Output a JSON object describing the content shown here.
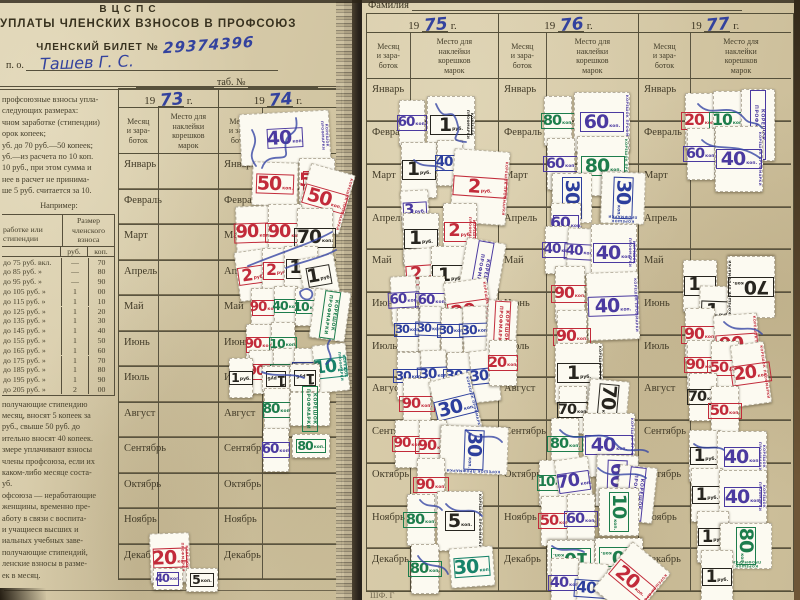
{
  "left_page": {
    "org": "ВЦСПС",
    "title": "УПЛАТЫ ЧЛЕНСКИХ ВЗНОСОВ В ПРОФСОЮЗ",
    "billet_label": "ЧЛЕНСКИЙ БИЛЕТ №",
    "billet_number": "29374396",
    "po_label": "п.  о.",
    "name_hand": "Ташев  Г.  С.",
    "tab_label": "таб.  №",
    "years": [
      "73",
      "74"
    ],
    "intro_lines": [
      "профсоюзные взносы упла-",
      "следующих размерах:",
      "чном заработке (стипендии)",
      "орок копеек;",
      "уб. до 70 руб.—50 копеек;",
      "уб.—из расчета по 10 коп.",
      "10 руб., при этом сумма и",
      "нее в расчет не принима-",
      "ше 5 руб. считается за 10."
    ],
    "example_label": "Например:",
    "rate_table": {
      "col1": "работке или\nстипендии",
      "col2": "Размер\nчленского\nвзноса",
      "rub": "руб.",
      "kop": "коп.",
      "rows": [
        [
          "до  75 руб. вкл.",
          "—",
          "70"
        ],
        [
          "до  85 руб.  »",
          "—",
          "80"
        ],
        [
          "до  95 руб.  »",
          "—",
          "90"
        ],
        [
          "до 105 руб.  »",
          "1",
          "00"
        ],
        [
          "до 115 руб.  »",
          "1",
          "10"
        ],
        [
          "до 125 руб.  »",
          "1",
          "20"
        ],
        [
          "до 135 руб.  »",
          "1",
          "30"
        ],
        [
          "до 145 руб.  »",
          "1",
          "40"
        ],
        [
          "до 155 руб.  »",
          "1",
          "50"
        ],
        [
          "до 165 руб.  »",
          "1",
          "60"
        ],
        [
          "до 175 руб.  »",
          "1",
          "70"
        ],
        [
          "до 185 руб.  »",
          "1",
          "80"
        ],
        [
          "до 195 руб.  »",
          "1",
          "90"
        ],
        [
          "до 205 руб.  »",
          "2",
          "00"
        ]
      ]
    },
    "bottom_lines": [
      "получающие  стипендию",
      "месяц, вносят 5 копеек за",
      "руб.,  свыше  50  руб.  до",
      "ительно вносят 40 копеек.",
      "змере уплачивают взносы",
      "члены профсоюза, если их",
      "каком-либо месяце соста-",
      "уб.",
      "офсоюза — неработающие",
      "женщины,  временно  пре-",
      "аботу в связи с воспита-",
      "и  учащиеся  высших  и",
      "иальных  учебных  заве-",
      "получающие   стипендий,",
      "ленские взносы в разме-",
      "ек в месяц."
    ]
  },
  "right_page": {
    "family_label": "Фамилия",
    "years": [
      "75",
      "76",
      "77"
    ],
    "footer": "ШФ. Г"
  },
  "table": {
    "year_prefix": "19",
    "year_suffix": "г.",
    "month_col": "Месяц\nи зара-\nботок",
    "place_col": "Место для\nнаклейки\nкорешков\nмарок",
    "months": [
      "Январь",
      "Февраль",
      "Март",
      "Апрель",
      "Май",
      "Июнь",
      "Июль",
      "Август",
      "Сентябрь",
      "Октябрь",
      "Ноябрь",
      "Декабрь"
    ]
  },
  "stamps": {
    "side_label": "КОРЕШОК ПРОФМАРКИ",
    "unit_kop": "коп.",
    "unit_rub": "руб.",
    "colors": {
      "red": "#c22b3a",
      "pur": "#4b3aa0",
      "grn": "#1d7d4c",
      "blu": "#2d3f9d",
      "blk": "#27251f",
      "tea": "#17836a"
    },
    "items": [
      [
        240,
        112,
        90,
        52,
        -3,
        "pur",
        "40",
        "k",
        "sv"
      ],
      [
        252,
        162,
        46,
        44,
        2,
        "red",
        "50",
        "k",
        ""
      ],
      [
        299,
        158,
        36,
        46,
        0,
        "red",
        "50",
        "k",
        ""
      ],
      [
        302,
        168,
        46,
        62,
        16,
        "red",
        "50",
        "k",
        "sv"
      ],
      [
        236,
        206,
        34,
        54,
        -2,
        "red",
        "90",
        "k",
        "v"
      ],
      [
        268,
        204,
        34,
        58,
        0,
        "red",
        "90",
        "k",
        "v"
      ],
      [
        297,
        208,
        36,
        60,
        0,
        "blk",
        "70",
        "k",
        "v"
      ],
      [
        237,
        250,
        32,
        50,
        -8,
        "red",
        "2",
        "r",
        "v"
      ],
      [
        262,
        248,
        30,
        46,
        0,
        "red",
        "2",
        "r",
        "v"
      ],
      [
        284,
        246,
        34,
        46,
        0,
        "blk",
        "1",
        "r",
        "v"
      ],
      [
        301,
        256,
        36,
        40,
        -10,
        "blk",
        "1",
        "r",
        "v"
      ],
      [
        251,
        288,
        26,
        40,
        0,
        "red",
        "90",
        "k",
        "v"
      ],
      [
        274,
        286,
        24,
        40,
        0,
        "grn",
        "40",
        "k",
        "v"
      ],
      [
        295,
        288,
        24,
        38,
        0,
        "grn",
        "10",
        "k",
        "v"
      ],
      [
        312,
        290,
        36,
        50,
        8,
        "grn",
        "",
        "k",
        "sb"
      ],
      [
        246,
        324,
        26,
        42,
        0,
        "red",
        "90",
        "k",
        "v"
      ],
      [
        271,
        322,
        24,
        44,
        0,
        "grn",
        "10",
        "k",
        "v"
      ],
      [
        249,
        350,
        26,
        44,
        0,
        "red",
        "90",
        "k",
        "v"
      ],
      [
        273,
        348,
        24,
        46,
        0,
        "grn",
        "40",
        "k",
        "v"
      ],
      [
        294,
        348,
        22,
        42,
        0,
        "blu",
        "10",
        "k",
        "v"
      ],
      [
        314,
        344,
        34,
        48,
        -6,
        "tea",
        "10",
        "k",
        "sv"
      ],
      [
        229,
        358,
        24,
        40,
        0,
        "blk",
        "1",
        "r",
        "v"
      ],
      [
        262,
        366,
        28,
        26,
        180,
        "blk",
        "1",
        "r",
        ""
      ],
      [
        290,
        364,
        30,
        28,
        180,
        "blk",
        "1",
        "r",
        ""
      ],
      [
        264,
        388,
        26,
        44,
        0,
        "grn",
        "80",
        "k",
        "v"
      ],
      [
        290,
        392,
        40,
        34,
        0,
        "grn",
        "",
        "k",
        "sb"
      ],
      [
        263,
        428,
        26,
        44,
        0,
        "pur",
        "60",
        "k",
        "v"
      ],
      [
        292,
        434,
        38,
        24,
        0,
        "grn",
        "80",
        "k",
        ""
      ],
      [
        150,
        533,
        40,
        50,
        -2,
        "red",
        "20",
        "k",
        "sv"
      ],
      [
        153,
        568,
        30,
        22,
        0,
        "pur",
        "40",
        "k",
        ""
      ],
      [
        186,
        568,
        32,
        24,
        0,
        "blk",
        "5",
        "k",
        ""
      ],
      [
        399,
        100,
        26,
        46,
        0,
        "pur",
        "60",
        "k",
        "v"
      ],
      [
        427,
        96,
        48,
        58,
        0,
        "blk",
        "1",
        "r",
        "sv"
      ],
      [
        401,
        142,
        36,
        56,
        0,
        "blk",
        "1",
        "r",
        "v"
      ],
      [
        437,
        140,
        26,
        46,
        0,
        "blu",
        "40",
        "k",
        "v"
      ],
      [
        452,
        150,
        56,
        74,
        4,
        "red",
        "2",
        "r",
        "sv"
      ],
      [
        401,
        190,
        28,
        40,
        -3,
        "pur",
        "3",
        "r",
        "v"
      ],
      [
        403,
        213,
        36,
        52,
        0,
        "blk",
        "1",
        "r",
        "v"
      ],
      [
        443,
        203,
        34,
        58,
        0,
        "red",
        "2",
        "r",
        "sv"
      ],
      [
        405,
        248,
        34,
        54,
        -4,
        "red",
        "2",
        "r",
        "v"
      ],
      [
        431,
        246,
        38,
        58,
        0,
        "blk",
        "1",
        "r",
        "v"
      ],
      [
        461,
        240,
        40,
        68,
        10,
        "pur",
        "",
        "k",
        "sb"
      ],
      [
        391,
        276,
        26,
        48,
        -3,
        "pur",
        "60",
        "k",
        "v"
      ],
      [
        419,
        276,
        26,
        50,
        0,
        "pur",
        "60",
        "k",
        "v"
      ],
      [
        447,
        280,
        44,
        62,
        -8,
        "red",
        "20",
        "k",
        "sv"
      ],
      [
        397,
        308,
        22,
        44,
        0,
        "blu",
        "30",
        "k",
        "v"
      ],
      [
        419,
        306,
        22,
        46,
        2,
        "blu",
        "30",
        "k",
        "v"
      ],
      [
        441,
        308,
        22,
        46,
        0,
        "blu",
        "30",
        "k",
        "v"
      ],
      [
        463,
        306,
        24,
        48,
        -2,
        "blu",
        "30",
        "k",
        "v"
      ],
      [
        487,
        300,
        30,
        52,
        3,
        "red",
        "",
        "k",
        "sb"
      ],
      [
        397,
        352,
        24,
        48,
        0,
        "blu",
        "30",
        "k",
        "v"
      ],
      [
        421,
        350,
        26,
        50,
        -2,
        "blu",
        "30",
        "k",
        "v"
      ],
      [
        447,
        352,
        26,
        50,
        0,
        "blu",
        "30",
        "k",
        "v"
      ],
      [
        471,
        350,
        28,
        52,
        -6,
        "blu",
        "30",
        "k",
        "v"
      ],
      [
        489,
        340,
        28,
        46,
        0,
        "red",
        "20",
        "k",
        "v"
      ],
      [
        403,
        378,
        28,
        52,
        0,
        "red",
        "90",
        "k",
        "v"
      ],
      [
        435,
        376,
        42,
        62,
        -14,
        "blu",
        "30",
        "k",
        "sv"
      ],
      [
        395,
        420,
        26,
        48,
        0,
        "red",
        "90",
        "k",
        "v"
      ],
      [
        419,
        420,
        28,
        52,
        0,
        "red",
        "90",
        "k",
        "v"
      ],
      [
        450,
        416,
        48,
        68,
        92,
        "blu",
        "30",
        "k",
        "s"
      ],
      [
        417,
        458,
        28,
        54,
        0,
        "red",
        "90",
        "k",
        "v"
      ],
      [
        407,
        494,
        28,
        52,
        0,
        "grn",
        "80",
        "k",
        "v"
      ],
      [
        437,
        491,
        46,
        60,
        0,
        "blk",
        "5",
        "k",
        "s"
      ],
      [
        411,
        544,
        28,
        50,
        0,
        "grn",
        "80",
        "k",
        "v"
      ],
      [
        450,
        547,
        44,
        40,
        -4,
        "tea",
        "30",
        "k",
        ""
      ],
      [
        544,
        96,
        28,
        50,
        0,
        "grn",
        "80",
        "k",
        "v"
      ],
      [
        574,
        92,
        56,
        60,
        0,
        "pur",
        "60",
        "k",
        "sv"
      ],
      [
        547,
        138,
        28,
        52,
        0,
        "pur",
        "60",
        "k",
        "v"
      ],
      [
        577,
        136,
        52,
        60,
        0,
        "grn",
        "80",
        "k",
        "sv"
      ],
      [
        547,
        178,
        50,
        40,
        90,
        "blu",
        "30",
        "k",
        ""
      ],
      [
        597,
        176,
        52,
        44,
        92,
        "blu",
        "30",
        "k",
        "s"
      ],
      [
        551,
        203,
        30,
        42,
        0,
        "pur",
        "60",
        "k",
        "v"
      ],
      [
        545,
        226,
        26,
        48,
        0,
        "pur",
        "40",
        "k",
        "v"
      ],
      [
        567,
        228,
        26,
        48,
        3,
        "pur",
        "40",
        "k",
        "v"
      ],
      [
        591,
        224,
        46,
        58,
        0,
        "pur",
        "40",
        "k",
        "sv"
      ],
      [
        555,
        266,
        30,
        56,
        0,
        "red",
        "90",
        "k",
        "v"
      ],
      [
        587,
        272,
        52,
        68,
        -2,
        "pur",
        "40",
        "k",
        "sv"
      ],
      [
        557,
        310,
        30,
        54,
        0,
        "red",
        "90",
        "k",
        "v"
      ],
      [
        555,
        343,
        48,
        60,
        0,
        "blk",
        "1",
        "r",
        "sv"
      ],
      [
        559,
        386,
        28,
        48,
        0,
        "blk",
        "70",
        "k",
        "v"
      ],
      [
        585,
        383,
        46,
        40,
        95,
        "blk",
        "70",
        "k",
        ""
      ],
      [
        551,
        418,
        28,
        52,
        0,
        "grn",
        "80",
        "k",
        "v"
      ],
      [
        583,
        413,
        52,
        64,
        0,
        "pur",
        "40",
        "k",
        "sv"
      ],
      [
        539,
        460,
        26,
        46,
        0,
        "grn",
        "10",
        "k",
        "v"
      ],
      [
        557,
        458,
        34,
        48,
        -8,
        "pur",
        "70",
        "k",
        "v"
      ],
      [
        591,
        460,
        52,
        42,
        92,
        "pur",
        "60",
        "k",
        ""
      ],
      [
        617,
        466,
        38,
        56,
        6,
        "pur",
        "",
        "k",
        "sb"
      ],
      [
        541,
        496,
        28,
        50,
        0,
        "red",
        "50",
        "k",
        "v"
      ],
      [
        567,
        494,
        28,
        50,
        0,
        "pur",
        "60",
        "k",
        "v"
      ],
      [
        595,
        492,
        48,
        40,
        90,
        "grn",
        "10",
        "k",
        ""
      ],
      [
        547,
        540,
        48,
        36,
        180,
        "grn",
        "10",
        "k",
        ""
      ],
      [
        595,
        538,
        48,
        38,
        180,
        "grn",
        "10",
        "k",
        ""
      ],
      [
        551,
        558,
        28,
        50,
        0,
        "pur",
        "40",
        "k",
        "v"
      ],
      [
        577,
        563,
        30,
        52,
        4,
        "blu",
        "40",
        "k",
        "v"
      ],
      [
        607,
        550,
        50,
        62,
        40,
        "red",
        "20",
        "k",
        "sv"
      ],
      [
        685,
        93,
        30,
        56,
        0,
        "red",
        "20",
        "k",
        "v"
      ],
      [
        713,
        91,
        30,
        60,
        0,
        "grn",
        "10",
        "k",
        "v"
      ],
      [
        741,
        89,
        34,
        72,
        0,
        "pur",
        "",
        "k",
        "sb"
      ],
      [
        687,
        128,
        28,
        52,
        0,
        "pur",
        "60",
        "k",
        "v"
      ],
      [
        715,
        126,
        48,
        66,
        0,
        "pur",
        "40",
        "k",
        "sv"
      ],
      [
        683,
        260,
        34,
        52,
        0,
        "blk",
        "1",
        "r",
        "v"
      ],
      [
        699,
        286,
        38,
        50,
        2,
        "blk",
        "1",
        "r",
        "v"
      ],
      [
        727,
        256,
        48,
        62,
        180,
        "blk",
        "70",
        "k",
        "sv"
      ],
      [
        685,
        308,
        30,
        54,
        0,
        "red",
        "90",
        "k",
        "v"
      ],
      [
        715,
        314,
        44,
        60,
        -4,
        "red",
        "90",
        "k",
        "sv"
      ],
      [
        687,
        340,
        28,
        50,
        0,
        "red",
        "90",
        "k",
        "v"
      ],
      [
        711,
        341,
        28,
        54,
        0,
        "red",
        "50",
        "k",
        "v"
      ],
      [
        734,
        343,
        34,
        62,
        -8,
        "red",
        "20",
        "k",
        "sv"
      ],
      [
        689,
        373,
        28,
        48,
        0,
        "blk",
        "70",
        "k",
        "v"
      ],
      [
        711,
        386,
        28,
        50,
        0,
        "red",
        "50",
        "k",
        "v"
      ],
      [
        689,
        430,
        32,
        52,
        0,
        "blk",
        "1",
        "r",
        "v"
      ],
      [
        717,
        431,
        50,
        52,
        0,
        "pur",
        "40",
        "k",
        "sv"
      ],
      [
        691,
        468,
        32,
        54,
        0,
        "blk",
        "1",
        "r",
        "v"
      ],
      [
        719,
        470,
        48,
        54,
        0,
        "pur",
        "40",
        "k",
        "sv"
      ],
      [
        697,
        511,
        32,
        52,
        0,
        "blk",
        "1",
        "r",
        "v"
      ],
      [
        723,
        520,
        46,
        52,
        90,
        "grn",
        "80",
        "k",
        "s"
      ],
      [
        701,
        550,
        32,
        54,
        0,
        "blk",
        "1",
        "r",
        "v"
      ]
    ]
  }
}
